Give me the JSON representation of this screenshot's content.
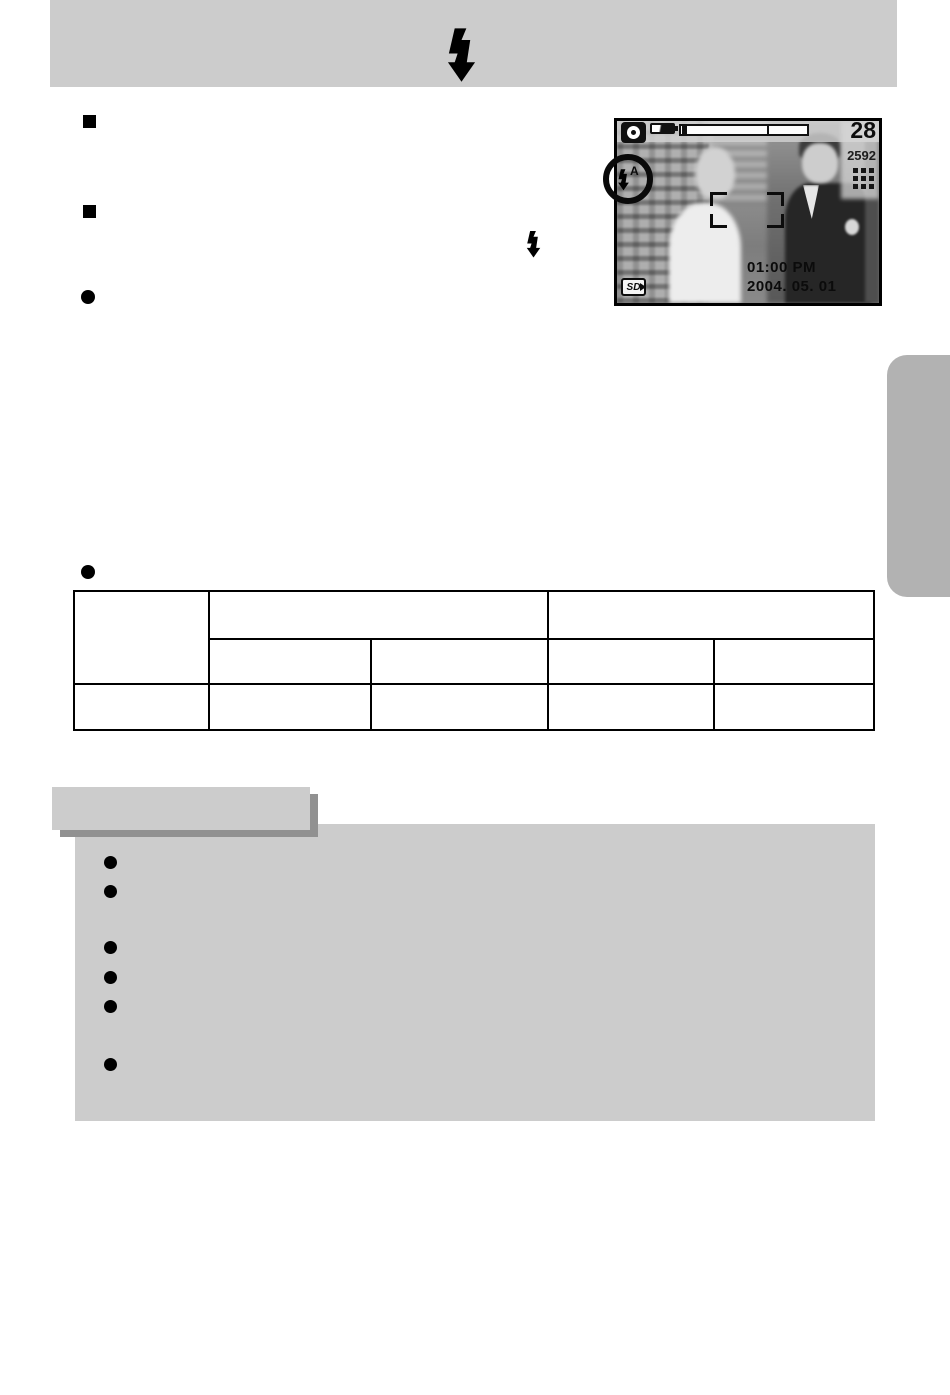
{
  "page": {
    "kind": "camera-manual-page",
    "header": {
      "bar_color": "#cccccc",
      "icon": "flash-bolt-icon"
    },
    "lcd_screen": {
      "shots_remaining": "28",
      "resolution": "2592",
      "time": "01:00 PM",
      "date": "2004. 05. 01",
      "sd_label": "SD",
      "flash_auto_letter": "A",
      "icons": [
        "camera-mode-icon",
        "battery-icon",
        "zoom-bar",
        "quality-dots-icon",
        "flash-auto-indicator",
        "focus-frame",
        "sd-card-icon"
      ]
    },
    "bullets": {
      "square_items": 2,
      "round_items": 2,
      "inline_icon": "flash-bolt-icon"
    },
    "table": {
      "columns": 5,
      "layout": "first column spans two header rows; two merged header cells above four sub-header cells; one data row",
      "cells": [
        [
          "",
          "",
          "",
          "",
          ""
        ],
        [
          "",
          "",
          "",
          "",
          ""
        ],
        [
          "",
          "",
          "",
          "",
          ""
        ]
      ]
    },
    "info_box": {
      "bullet_count": 6,
      "panel_color": "#cccccc",
      "shadow_color": "#919191"
    },
    "side_tab": {
      "color": "#b2b2b2"
    },
    "colors": {
      "panel_gray": "#cccccc",
      "side_tab_gray": "#b2b2b2",
      "shadow_gray": "#919191",
      "ink": "#000000"
    }
  }
}
